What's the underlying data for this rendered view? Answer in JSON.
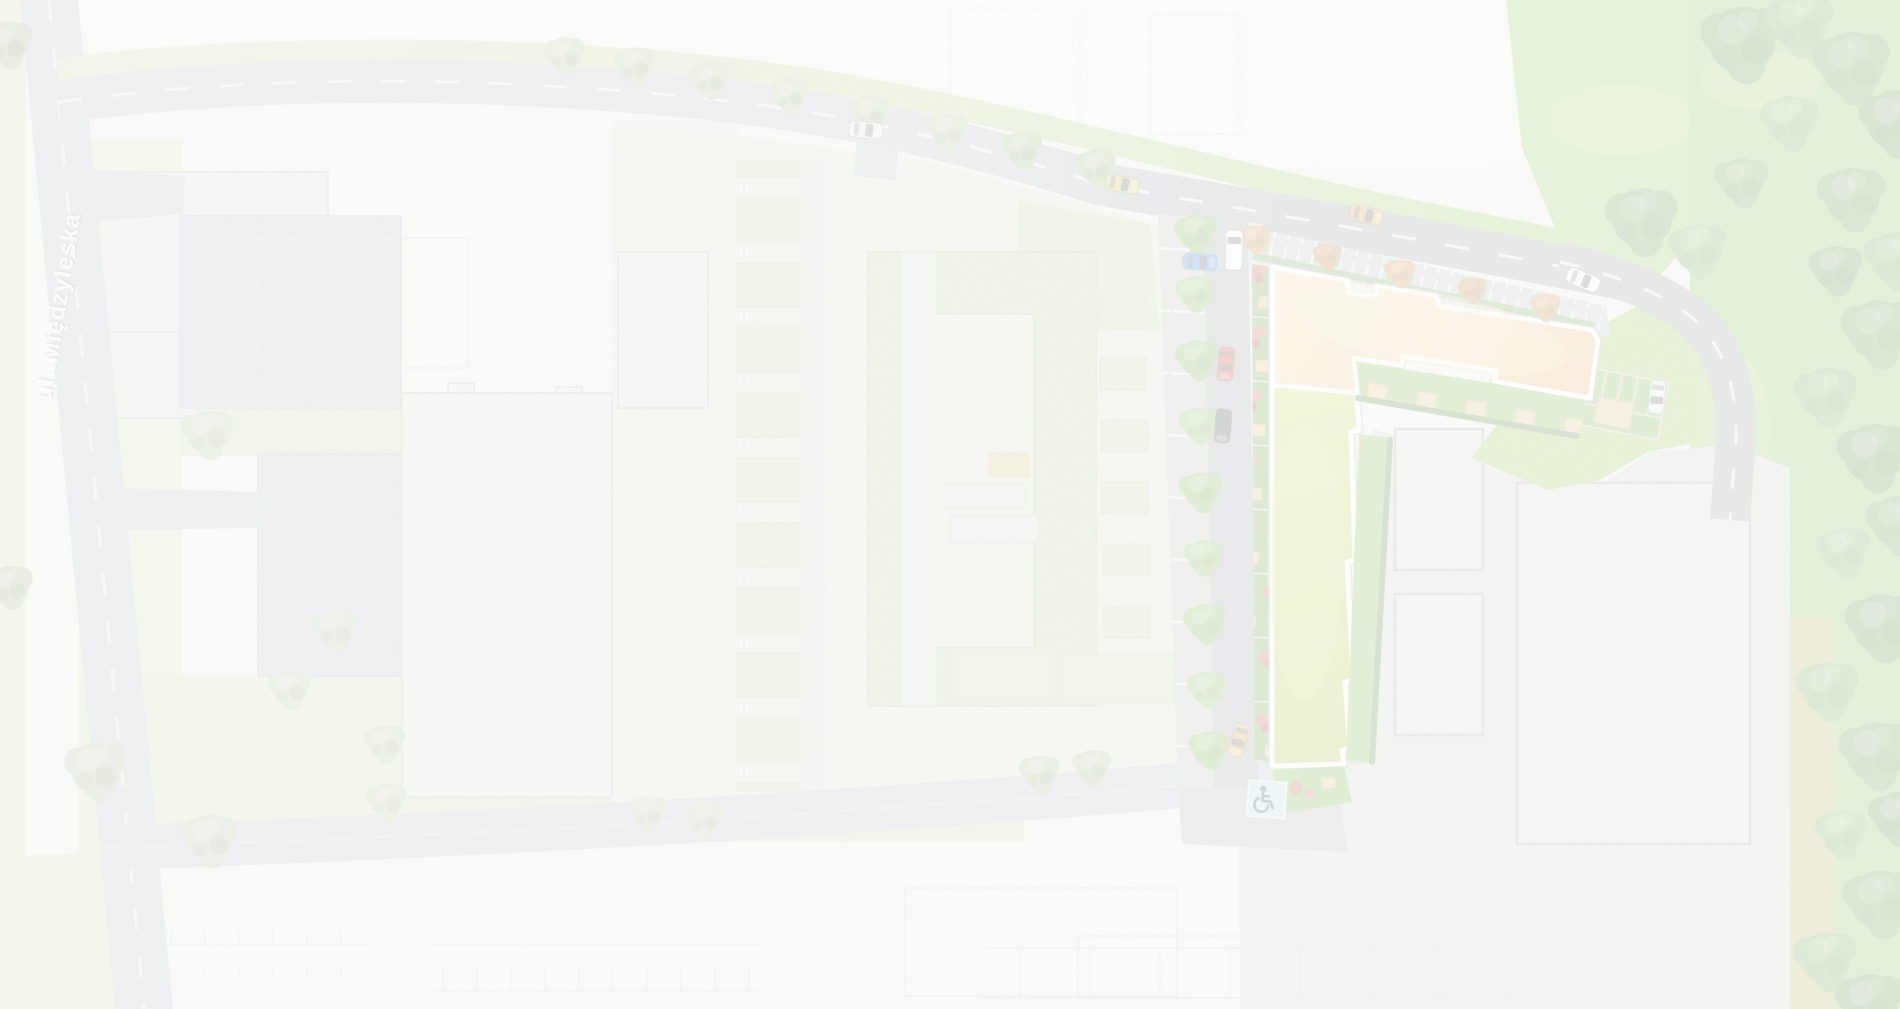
{
  "map": {
    "type": "architectural-site-plan",
    "street_label": "ul. Międzyleska",
    "icons": {
      "accessible_parking": "wheelchair-icon"
    },
    "highlight": {
      "label": "new L-shaped residential building",
      "roof_sand_color": "#edc378",
      "roof_green_color": "#aec332",
      "outline_color": "#ffffff"
    },
    "colors": {
      "road_new": "#8f9496",
      "road_context": "#b6bac1",
      "road_dash": "#eef0f0",
      "lawn_bright": "#8ec544",
      "lawn_pale": "#ccd9a8",
      "pavement": "#cbcfc7",
      "parking_bay": "#b9bdb5",
      "hedge_dark": "#47762c",
      "flower_red": "#bc4a3c",
      "terrace_tan": "#d9bf7c",
      "accessible_blue": "#b9d9e3",
      "context_building": "#dfe3da",
      "context_parking_blue": "#b8bac6"
    },
    "scene": {
      "vehicles": [
        {
          "name": "car-white-top-road",
          "sym": "car",
          "x": 866,
          "y": 130,
          "rot": 96,
          "c": "#f3f4f2",
          "o": 0.8
        },
        {
          "name": "car-yellow-top-road",
          "sym": "car",
          "x": 1122,
          "y": 184,
          "rot": 101,
          "c": "#c5bd4e"
        },
        {
          "name": "car-orange-top-road",
          "sym": "car",
          "x": 1366,
          "y": 215,
          "rot": 104,
          "c": "#d89e46"
        },
        {
          "name": "car-white-parked-kerb",
          "sym": "car",
          "x": 1583,
          "y": 280,
          "rot": 113,
          "c": "#f6f7f4"
        },
        {
          "name": "car-silver-parking-stall",
          "sym": "car",
          "x": 1657,
          "y": 397,
          "rot": 185,
          "c": "#dcdfdf"
        },
        {
          "name": "van-white-street",
          "sym": "van",
          "x": 1234,
          "y": 250,
          "rot": 2,
          "c": "#f6f7f4"
        },
        {
          "name": "car-blue-parked-bay",
          "sym": "car",
          "x": 1200,
          "y": 262,
          "rot": 94,
          "c": "#2e77cf"
        },
        {
          "name": "car-red-street",
          "sym": "car",
          "x": 1226,
          "y": 364,
          "rot": 185,
          "c": "#ce2b26"
        },
        {
          "name": "car-dark-street",
          "sym": "car",
          "x": 1223,
          "y": 426,
          "rot": 185,
          "c": "#313b33"
        },
        {
          "name": "car-orange-street",
          "sym": "car",
          "x": 1239,
          "y": 740,
          "rot": 197,
          "c": "#d8a24b"
        }
      ],
      "trees": {
        "context": [
          {
            "x": 208,
            "y": 432,
            "s": 1.35,
            "c": "#a9bf92"
          },
          {
            "x": 335,
            "y": 628,
            "s": 1.2,
            "c": "#a9bf92"
          },
          {
            "x": 290,
            "y": 688,
            "s": 1.1,
            "c": "#a9bf92"
          },
          {
            "x": 96,
            "y": 768,
            "s": 1.6,
            "c": "#9db788"
          },
          {
            "x": 210,
            "y": 838,
            "s": 1.45,
            "c": "#a3bb8c"
          },
          {
            "x": 385,
            "y": 742,
            "s": 1.05,
            "c": "#a9bf92"
          },
          {
            "x": 387,
            "y": 800,
            "s": 1.05,
            "c": "#a9bf92"
          },
          {
            "x": 8,
            "y": 42,
            "s": 1.3,
            "c": "#8fa878"
          },
          {
            "x": 10,
            "y": 585,
            "s": 1.2,
            "c": "#8fa878"
          },
          {
            "x": 648,
            "y": 812,
            "s": 1.0,
            "c": "#a9bf92"
          },
          {
            "x": 705,
            "y": 818,
            "s": 0.95,
            "c": "#a9bf92"
          },
          {
            "x": 1040,
            "y": 772,
            "s": 1.05,
            "c": "#98b47e"
          },
          {
            "x": 1092,
            "y": 766,
            "s": 1.0,
            "c": "#98b47e"
          }
        ],
        "top_verge": [
          {
            "x": 565,
            "y": 54,
            "s": 1.05,
            "c": "#a3bd85"
          },
          {
            "x": 635,
            "y": 64,
            "s": 1.05,
            "c": "#a3bd85"
          },
          {
            "x": 710,
            "y": 78,
            "s": 1.05,
            "c": "#a3bd85"
          },
          {
            "x": 790,
            "y": 94,
            "s": 1.0,
            "c": "#a3bd85"
          },
          {
            "x": 870,
            "y": 112,
            "s": 1.05,
            "c": "#a3bd85"
          },
          {
            "x": 948,
            "y": 130,
            "s": 1.05,
            "c": "#a3bd85"
          },
          {
            "x": 1022,
            "y": 148,
            "s": 1.05,
            "c": "#8fb168"
          },
          {
            "x": 1096,
            "y": 166,
            "s": 1.05,
            "c": "#8fb168"
          }
        ],
        "street_row": [
          {
            "x": 1196,
            "y": 232,
            "s": 1.1,
            "c": "#74ac44"
          },
          {
            "x": 1195,
            "y": 292,
            "s": 1.0,
            "c": "#7cb24a"
          },
          {
            "x": 1197,
            "y": 358,
            "s": 1.1,
            "c": "#74ac44"
          },
          {
            "x": 1199,
            "y": 424,
            "s": 1.0,
            "c": "#7cb24a"
          },
          {
            "x": 1201,
            "y": 490,
            "s": 1.1,
            "c": "#74ac44"
          },
          {
            "x": 1203,
            "y": 556,
            "s": 1.0,
            "c": "#7cb24a"
          },
          {
            "x": 1205,
            "y": 622,
            "s": 1.1,
            "c": "#74ac44"
          },
          {
            "x": 1207,
            "y": 688,
            "s": 1.0,
            "c": "#7cb24a"
          },
          {
            "x": 1209,
            "y": 748,
            "s": 1.05,
            "c": "#74ac44"
          }
        ],
        "north_parking_row": [
          {
            "x": 1255,
            "y": 238,
            "s": 0.78,
            "c": "#c9833d"
          },
          {
            "x": 1327,
            "y": 255,
            "s": 0.72,
            "c": "#bd762f"
          },
          {
            "x": 1400,
            "y": 272,
            "s": 0.78,
            "c": "#c9833d"
          },
          {
            "x": 1472,
            "y": 289,
            "s": 0.72,
            "c": "#bd762f"
          },
          {
            "x": 1545,
            "y": 306,
            "s": 0.78,
            "c": "#c9833d"
          }
        ],
        "right_band": [
          {
            "x": 1742,
            "y": 40,
            "s": 2.1,
            "c": "#4f8a34"
          },
          {
            "x": 1800,
            "y": 22,
            "s": 1.75,
            "c": "#63a041"
          },
          {
            "x": 1852,
            "y": 64,
            "s": 2.0,
            "c": "#578f38"
          },
          {
            "x": 1896,
            "y": 120,
            "s": 1.87,
            "c": "#4a8230"
          },
          {
            "x": 1790,
            "y": 120,
            "s": 1.5,
            "c": "#6aa746"
          },
          {
            "x": 1742,
            "y": 180,
            "s": 1.37,
            "c": "#5a9138"
          },
          {
            "x": 1642,
            "y": 218,
            "s": 1.87,
            "c": "#578f38"
          },
          {
            "x": 1698,
            "y": 248,
            "s": 1.5,
            "c": "#6aa746"
          },
          {
            "x": 1852,
            "y": 196,
            "s": 1.75,
            "c": "#568e37"
          },
          {
            "x": 1896,
            "y": 258,
            "s": 1.62,
            "c": "#63a041"
          },
          {
            "x": 1836,
            "y": 268,
            "s": 1.37,
            "c": "#4d8532"
          },
          {
            "x": 1878,
            "y": 330,
            "s": 1.87,
            "c": "#578f38"
          },
          {
            "x": 1826,
            "y": 394,
            "s": 1.62,
            "c": "#63a041"
          },
          {
            "x": 1874,
            "y": 454,
            "s": 1.87,
            "c": "#4d8532"
          },
          {
            "x": 1898,
            "y": 522,
            "s": 1.62,
            "c": "#578f38"
          },
          {
            "x": 1844,
            "y": 550,
            "s": 1.37,
            "c": "#6aa746"
          },
          {
            "x": 1882,
            "y": 624,
            "s": 1.87,
            "c": "#4d8532"
          },
          {
            "x": 1828,
            "y": 688,
            "s": 1.62,
            "c": "#63a041"
          },
          {
            "x": 1876,
            "y": 752,
            "s": 1.87,
            "c": "#568e37"
          },
          {
            "x": 1898,
            "y": 816,
            "s": 1.5,
            "c": "#4d8532"
          },
          {
            "x": 1842,
            "y": 832,
            "s": 1.37,
            "c": "#6aa746"
          },
          {
            "x": 1880,
            "y": 900,
            "s": 1.87,
            "c": "#578f38"
          },
          {
            "x": 1826,
            "y": 958,
            "s": 1.62,
            "c": "#63a041"
          },
          {
            "x": 1870,
            "y": 1002,
            "s": 1.75,
            "c": "#4d8532"
          }
        ]
      }
    }
  }
}
